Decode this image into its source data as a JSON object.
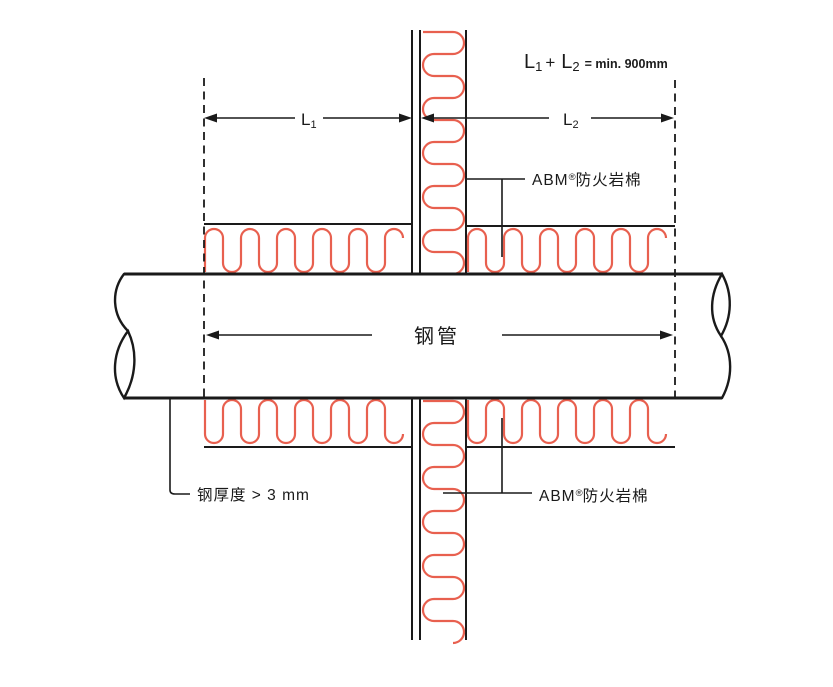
{
  "diagram": {
    "formula": {
      "term1": "L",
      "term1_sub": "1",
      "operator": "+",
      "term2": "L",
      "term2_sub": "2",
      "result": "= min. 900mm"
    },
    "dim_l1": {
      "label": "L",
      "sub": "1"
    },
    "dim_l2": {
      "label": "L",
      "sub": "2"
    },
    "pipe_label": "钢管",
    "insulation_label_top": {
      "brand": "ABM",
      "reg": "®",
      "name": "防火岩棉"
    },
    "insulation_label_bottom": {
      "brand": "ABM",
      "reg": "®",
      "name": "防火岩棉"
    },
    "steel_thickness_note": "钢厚度 > 3 mm",
    "colors": {
      "line": "#1a1a1a",
      "insulation_red": "#e8604f",
      "background": "#ffffff"
    }
  }
}
